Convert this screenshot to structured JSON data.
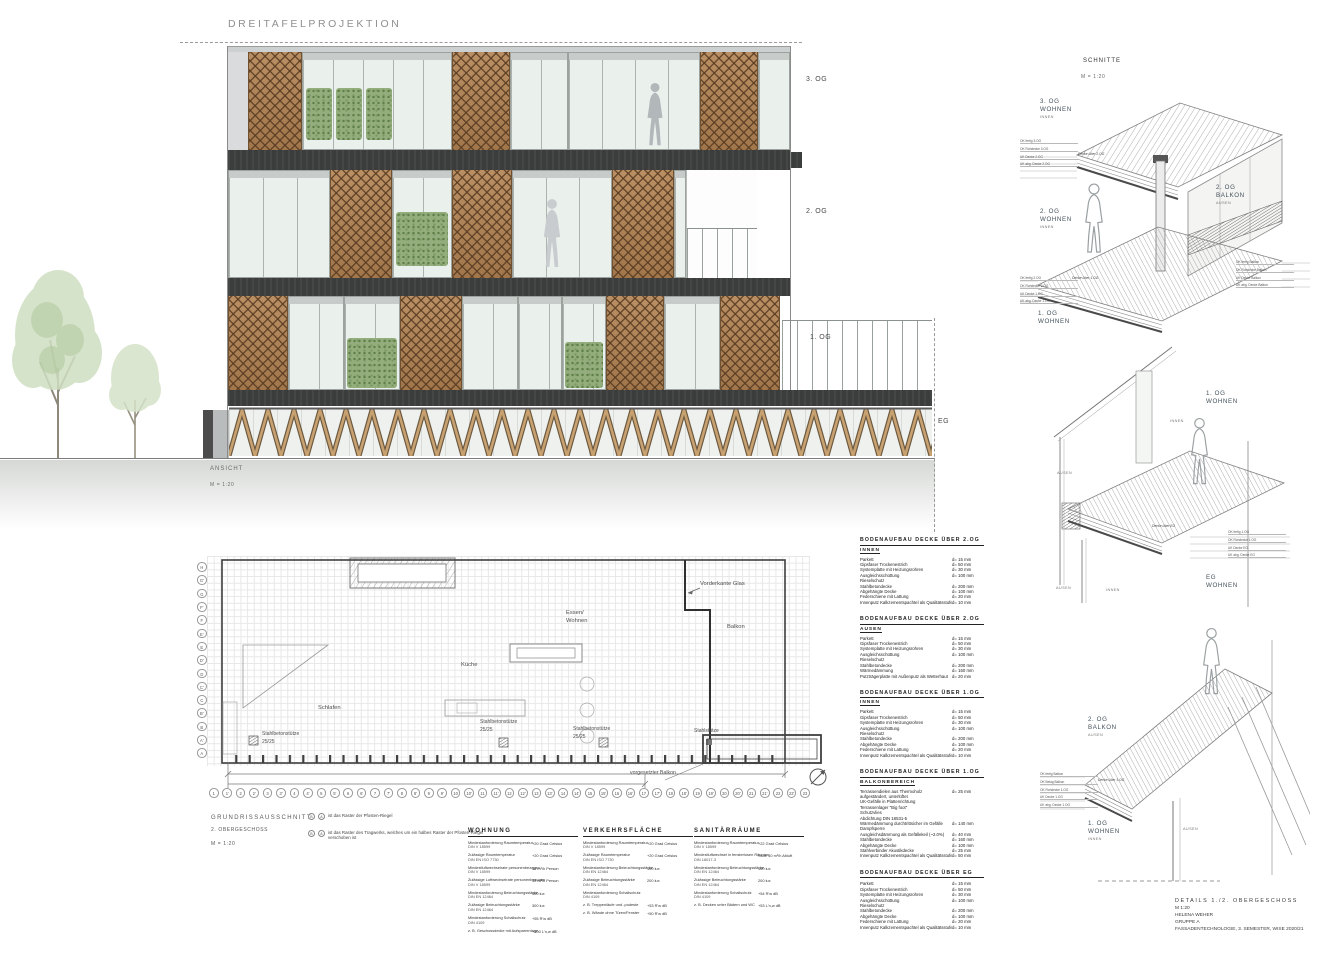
{
  "palette": {
    "lattice_brown": "#ab8258",
    "plant_green": "#93ad7c",
    "slab_dark": "#3b3d3c",
    "truss_tan": "#c8a171",
    "glass": "#eaf0ec"
  },
  "sheet": {
    "title": "DREITAFELPROJEKTION"
  },
  "elevation": {
    "caption": "ANSICHT",
    "scale": "M = 1:20",
    "floors": {
      "og3": "3. OG",
      "og2": "2. OG",
      "og1": "1. OG",
      "eg": "EG"
    }
  },
  "details": {
    "title": "SCHNITTE",
    "scale": "M = 1:20",
    "d1": {
      "og3": "3. OG",
      "og3b": "WOHNEN",
      "og3c": "INNEN",
      "og2": "2. OG",
      "og2b": "WOHNEN",
      "og2c": "INNEN",
      "balk": "2. OG",
      "balkb": "BALKON",
      "balkc": "AUSEN",
      "og1": "1. OG",
      "og1b": "WOHNEN",
      "slab_top": "Decke über 2.OG",
      "slab_bot": "Decke über 1.OG",
      "levels_top": [
        "OK fertig 3.OG",
        "OK Rohdecke 3.OG",
        "UK Decke 2.OG",
        "UK abg. Decke 2.OG"
      ],
      "levels_bot": [
        "OK fertig 2.OG",
        "OK Rohdecke 2.OG",
        "UK Decke 1.OG",
        "UK abg. Decke 1.OG"
      ],
      "levels_balkon": [
        "OK fertig Balkon",
        "OK Rohdecke Balkon",
        "UK Decke Balkon",
        "UK abg. Decke Balkon"
      ]
    },
    "d2": {
      "og1": "1. OG",
      "og1b": "WOHNEN",
      "innen": "INNEN",
      "aussen": "AUSEN",
      "eg": "EG",
      "egb": "WOHNEN",
      "aussen2": "AUSEN",
      "innen2": "INNEN",
      "slab": "Decke über EG",
      "levels": [
        "OK fertig 1.OG",
        "OK Rohdecke 1.OG",
        "UK Decke EG",
        "UK abg. Decke EG"
      ]
    },
    "d3": {
      "balk": "2. OG",
      "balkb": "BALKON",
      "balkc": "AUSEN",
      "og1": "1. OG",
      "og1b": "WOHNEN",
      "og1c": "INNEN",
      "wall": "AUSEN",
      "slab": "Decke über 1.OG",
      "levels": [
        "OK fertig Balkon",
        "OK Belag Balkon",
        "OK Rohdecke 1.OG",
        "UK Decke 1.OG",
        "UK abg. Decke 1.OG"
      ]
    }
  },
  "plan": {
    "cap1": "GRUNDRISSAUSSCHNITT",
    "cap2": "2. OBERGESCHOSS",
    "cap3": "M = 1:20",
    "rooms": {
      "schlafen": "Schlafen",
      "kueche": "Küche",
      "essen1": "Essen/",
      "essen2": "Wohnen",
      "balkon": "Balkon"
    },
    "notes": {
      "vorderkante": "Vorderkante Glas",
      "vorgesetzt": "vorgesetzter Balkon"
    },
    "columns": [
      {
        "l1": "Stahlbetonstütze",
        "l2": "25/25"
      },
      {
        "l1": "Stahlbetonstütze",
        "l2": "25/25"
      },
      {
        "l1": "Stahlbetonstütze",
        "l2": "25/25"
      },
      {
        "l1": "Stahlstütze",
        "l2": ""
      }
    ],
    "grid_letters": [
      "H",
      "G'",
      "G",
      "F'",
      "F",
      "E'",
      "E",
      "D'",
      "D",
      "C'",
      "C",
      "B'",
      "B",
      "A'",
      "A"
    ],
    "grid_numbers": [
      "1",
      "1'",
      "2",
      "2'",
      "3",
      "3'",
      "4",
      "4'",
      "5",
      "5'",
      "6",
      "6'",
      "7",
      "7'",
      "8",
      "8'",
      "9",
      "9'",
      "10",
      "10'",
      "11",
      "11'",
      "12",
      "12'",
      "13",
      "13'",
      "14",
      "14'",
      "15",
      "15'",
      "16",
      "16'",
      "17",
      "17'",
      "18",
      "18'",
      "19",
      "19'",
      "20",
      "20'",
      "21",
      "21'",
      "22",
      "22'",
      "23"
    ],
    "legend": [
      {
        "a": "B",
        "b": "A",
        "text": "ist das Raster der Pfosten-Riegel"
      },
      {
        "a": "B",
        "b": "A",
        "text": "ist das Raster des Tragwerks, welches um ein halbes Raster der Pfosten-Riegel verschoben ist"
      }
    ]
  },
  "bodenaufbau": {
    "s1": {
      "title": "BODENAUFBAU DECKE ÜBER 2.OG",
      "subtitle": "INNEN",
      "rows": [
        {
          "n": "Parkett",
          "v": "d= 15 mm"
        },
        {
          "n": "Gipsfaser Trockenestrich",
          "v": "d= 50 mm"
        },
        {
          "n": "Systemplatte mit Heizungsrohren",
          "v": "d= 30 mm"
        },
        {
          "n": "Ausgleichsschüttung",
          "v": "d= 100 mm"
        },
        {
          "n": "Rieselschutz",
          "v": ""
        },
        {
          "n": "Stahlbetondecke",
          "v": "d= 200 mm"
        },
        {
          "n": "Abgehängte Decke",
          "v": "d= 100 mm"
        },
        {
          "n": "Federschiene mit Lattung",
          "v": "d= 20 mm"
        },
        {
          "n": "Innenputz Kalkzementspachtel als Qualitätsstufe",
          "v": "d= 10 mm"
        }
      ]
    },
    "s2": {
      "title": "BODENAUFBAU DECKE ÜBER 2.OG",
      "subtitle": "AUSEN",
      "rows": [
        {
          "n": "Parkett",
          "v": "d= 15 mm"
        },
        {
          "n": "Gipsfaser Trockenestrich",
          "v": "d= 50 mm"
        },
        {
          "n": "Systemplatte mit Heizungsrohren",
          "v": "d= 30 mm"
        },
        {
          "n": "Ausgleichsschüttung",
          "v": "d= 100 mm"
        },
        {
          "n": "Rieselschutz",
          "v": ""
        },
        {
          "n": "Stahlbetondecke",
          "v": "d= 200 mm"
        },
        {
          "n": "Wärmedämmung",
          "v": "d= 160 mm"
        },
        {
          "n": "Putzträgerplatte mit Außenputz als Wetterhaut",
          "v": "d= 20 mm"
        }
      ]
    },
    "s3": {
      "title": "BODENAUFBAU DECKE ÜBER 1.OG",
      "subtitle": "INNEN",
      "rows": [
        {
          "n": "Parkett",
          "v": "d= 15 mm"
        },
        {
          "n": "Gipsfaser Trockenestrich",
          "v": "d= 50 mm"
        },
        {
          "n": "Systemplatte mit Heizungsrohren",
          "v": "d= 30 mm"
        },
        {
          "n": "Ausgleichsschüttung",
          "v": "d= 100 mm"
        },
        {
          "n": "Rieselschutz",
          "v": ""
        },
        {
          "n": "Stahlbetondecke",
          "v": "d= 200 mm"
        },
        {
          "n": "Abgehängte Decke",
          "v": "d= 100 mm"
        },
        {
          "n": "Federschiene mit Lattung",
          "v": "d= 20 mm"
        },
        {
          "n": "Innenputz Kalkzementspachtel als Qualitätsstufe",
          "v": "d= 10 mm"
        }
      ]
    },
    "s4": {
      "title": "BODENAUFBAU DECKE ÜBER 1.OG",
      "subtitle": "BALKONBEREICH",
      "rows": [
        {
          "n": "Terrassendielen aus Thermoholz",
          "v": "d= 25 mm"
        },
        {
          "n": "aufgeständert, unterlüftet",
          "v": ""
        },
        {
          "n": "UK-Gefälle in Plattenrichtung",
          "v": ""
        },
        {
          "n": "Terrassenlager \"Big foot\"",
          "v": ""
        },
        {
          "n": "Schutzvlies",
          "v": ""
        },
        {
          "n": "Abdichtung DIN 18531-5",
          "v": ""
        },
        {
          "n": "Wärmedämmung durchtrittsicher im Gefälle",
          "v": "d= 140 mm"
        },
        {
          "n": "Dampfsperre",
          "v": ""
        },
        {
          "n": "Ausgleichsdämmung als Gefällekeil (~2.0%)",
          "v": "d= 40 mm"
        },
        {
          "n": "Stahlbetondecke",
          "v": "d= 160 mm"
        },
        {
          "n": "Abgehängte Decke",
          "v": "d= 100 mm"
        },
        {
          "n": "Stahlverbinder Akustikdecke",
          "v": "d= 25 mm"
        },
        {
          "n": "Innenputz Kalkzementspachtel als Qualitätsstufe",
          "v": "d= 50 mm"
        }
      ]
    },
    "s5": {
      "title": "BODENAUFBAU DECKE ÜBER EG",
      "subtitle": "",
      "rows": [
        {
          "n": "Parkett",
          "v": "d= 15 mm"
        },
        {
          "n": "Gipsfaser Trockenestrich",
          "v": "d= 50 mm"
        },
        {
          "n": "Systemplatte mit Heizungsrohren",
          "v": "d= 30 mm"
        },
        {
          "n": "Ausgleichsschüttung",
          "v": "d= 100 mm"
        },
        {
          "n": "Rieselschutz",
          "v": ""
        },
        {
          "n": "Stahlbetondecke",
          "v": "d= 200 mm"
        },
        {
          "n": "Abgehängte Decke",
          "v": "d= 100 mm"
        },
        {
          "n": "Federschiene mit Lattung",
          "v": "d= 20 mm"
        },
        {
          "n": "Innenputz Kalkzementspachtel als Qualitätsstufe",
          "v": "d= 10 mm"
        }
      ]
    }
  },
  "requirements": {
    "wohnung": {
      "title": "WOHNUNG",
      "rows": [
        {
          "n": "Mindestanforderung Raumtemperatur",
          "d": "DIN V 18599",
          "v": "+20 Grad Celsius"
        },
        {
          "n": "Zulässige Raumtemperatur",
          "d": "DIN EN ISO 7730",
          "v": "+20 Grad Celsius"
        },
        {
          "n": "Mindestluftwechselrate personenbezogen",
          "d": "DIN V 18599",
          "v": "30 m³/h Person"
        },
        {
          "n": "Zulässige Luftwechselrate personenbezogen",
          "d": "DIN V 18599",
          "v": "30 m³/h Person"
        },
        {
          "n": "Mindestanforderung Beleuchtungsstärke",
          "d": "DIN EN 12464",
          "v": "300 lux"
        },
        {
          "n": "Zulässige Beleuchtungsstärke",
          "d": "DIN EN 12464",
          "v": "300 lux"
        },
        {
          "n": "Mindestanforderung Schallschutz",
          "d": "DIN 4109",
          "v": "+55 R'w dB"
        },
        {
          "n": "z. B. Geschossdecke mit Aufsparrenlage",
          "d": "",
          "v": "+100 L'n,w dB"
        }
      ]
    },
    "verkehr": {
      "title": "VERKEHRSFLÄCHE",
      "rows": [
        {
          "n": "Mindestanforderung Raumtemperatur",
          "d": "DIN V 18599",
          "v": "+20 Grad Celsius"
        },
        {
          "n": "Zulässige Raumtemperatur",
          "d": "DIN EN ISO 7730",
          "v": "+20 Grad Celsius"
        },
        {
          "n": "Mindestanforderung Beleuchtungsstärke",
          "d": "DIN EN 12464",
          "v": "100 lux"
        },
        {
          "n": "Zulässige Beleuchtungsstärke",
          "d": "DIN EN 12464",
          "v": "200 lux"
        },
        {
          "n": "Mindestanforderung Schallschutz",
          "d": "DIN 4109",
          "v": ""
        },
        {
          "n": "z. B. Treppenläufe und -podeste",
          "d": "",
          "v": "+53 R'w dB"
        },
        {
          "n": "z. B. Wände ohne Türen/Fenster",
          "d": "",
          "v": "+50 R'w dB"
        }
      ]
    },
    "sanitaer": {
      "title": "SANITÄRRÄUME",
      "rows": [
        {
          "n": "Mindestanforderung Raumtemperatur",
          "d": "DIN V 18599",
          "v": "+22 Grad Celsius"
        },
        {
          "n": "Mindestluftwechsel in fensterlosen Räumen",
          "d": "DIN 18017-3",
          "v": "Stufe 40 m³/h Abluft"
        },
        {
          "n": "Mindestanforderung Beleuchtungsstärke",
          "d": "DIN EN 12464",
          "v": "100 lux"
        },
        {
          "n": "Zulässige Beleuchtungsstärke",
          "d": "DIN EN 12464",
          "v": "200 lux"
        },
        {
          "n": "Mindestanforderung Schallschutz",
          "d": "DIN 4109",
          "v": "+54 R'w dB"
        },
        {
          "n": "z. B. Decken unter Bädern und WC",
          "d": "",
          "v": "+53 L'n,w dB"
        }
      ]
    }
  },
  "titleblock": {
    "l1": "DETAILS  1./2. OBERGESCHOSS",
    "l2": "M 1:20",
    "l3": "HELENA WEHER",
    "l4": "GRUPPE A",
    "l5": "FASSADENTECHNOLOGIE, 3. SEMESTER, WISE 2020/21"
  }
}
